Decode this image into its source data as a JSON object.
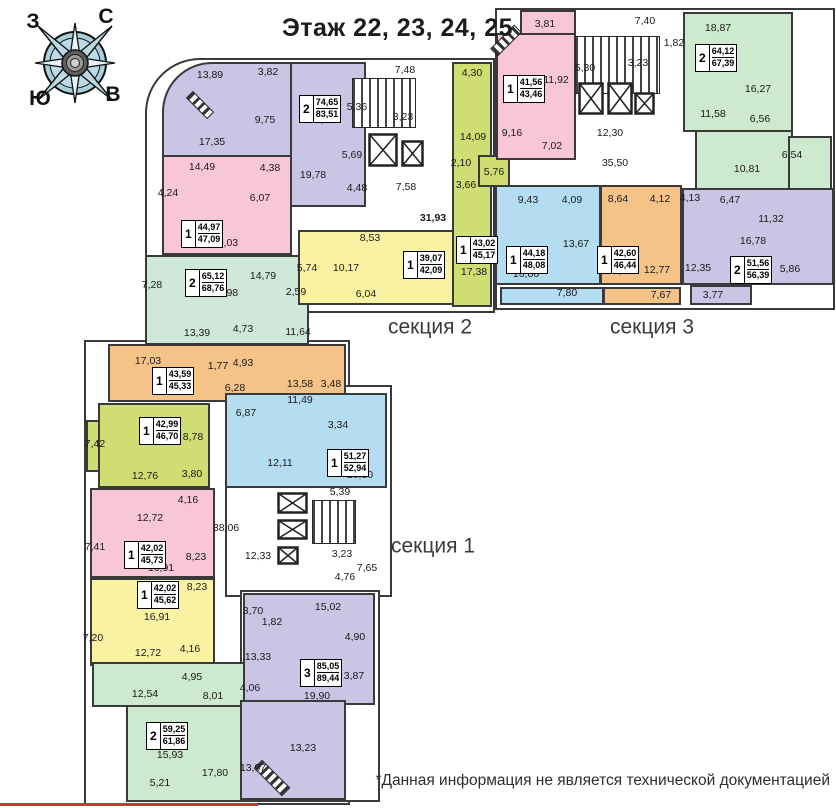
{
  "title": "Этаж 22, 23, 24, 25",
  "disclaimer": "*Данная информация не является технической документацией",
  "compass": {
    "north": "С",
    "south": "Ю",
    "west": "З",
    "east": "В"
  },
  "sections": [
    {
      "label": "секция 1",
      "x": 433,
      "y": 546
    },
    {
      "label": "секция 2",
      "x": 430,
      "y": 327
    },
    {
      "label": "секция 3",
      "x": 652,
      "y": 327
    }
  ],
  "apartments": [
    {
      "id": "s2-2k-8351",
      "rooms_count": "2",
      "area_living": "74,65",
      "area_total": "83,51",
      "color": "#c9c5e4",
      "badge": [
        299,
        95
      ],
      "blocks": [
        [
          162,
          62,
          130,
          95,
          "50px 0 0 0"
        ],
        [
          290,
          62,
          76,
          145
        ]
      ],
      "rooms": [
        [
          "13,89",
          210,
          75
        ],
        [
          "3,82",
          268,
          72
        ],
        [
          "9,75",
          265,
          120
        ],
        [
          "17,35",
          212,
          142
        ],
        [
          "17,60",
          322,
          120
        ],
        [
          "5,36",
          357,
          107
        ],
        [
          "5,69",
          352,
          155
        ],
        [
          "19,78",
          313,
          175
        ],
        [
          "4,48",
          357,
          188
        ]
      ]
    },
    {
      "id": "s2-1k-4709",
      "rooms_count": "1",
      "area_living": "44,97",
      "area_total": "47,09",
      "color": "#f7c6d8",
      "badge": [
        181,
        220
      ],
      "blocks": [
        [
          162,
          155,
          130,
          100
        ]
      ],
      "rooms": [
        [
          "14,49",
          202,
          167
        ],
        [
          "4,38",
          270,
          168
        ],
        [
          "4,24",
          168,
          193
        ],
        [
          "6,07",
          260,
          198
        ],
        [
          "20,03",
          225,
          243
        ]
      ]
    },
    {
      "id": "s2-2k-6876",
      "rooms_count": "2",
      "area_living": "65,12",
      "area_total": "68,76",
      "color": "#cfe8da",
      "badge": [
        185,
        269
      ],
      "blocks": [
        [
          145,
          255,
          164,
          90
        ]
      ],
      "rooms": [
        [
          "14,79",
          263,
          276
        ],
        [
          "7,28",
          152,
          285
        ],
        [
          "17,98",
          225,
          293
        ],
        [
          "2,59",
          296,
          292
        ],
        [
          "13,39",
          197,
          333
        ],
        [
          "4,73",
          243,
          329
        ],
        [
          "11,64",
          298,
          332
        ]
      ]
    },
    {
      "id": "s2-1k-4209",
      "rooms_count": "1",
      "area_living": "39,07",
      "area_total": "42,09",
      "color": "#faf2a3",
      "badge": [
        403,
        251
      ],
      "blocks": [
        [
          298,
          230,
          192,
          75
        ]
      ],
      "rooms": [
        [
          "8,53",
          370,
          238
        ],
        [
          "5,74",
          307,
          268
        ],
        [
          "10,17",
          346,
          268
        ],
        [
          "14,63",
          431,
          275
        ],
        [
          "6,04",
          366,
          294
        ]
      ]
    },
    {
      "id": "s2-1k-4517",
      "rooms_count": "1",
      "area_living": "43,02",
      "area_total": "45,17",
      "color": "#cfdd73",
      "badge": [
        456,
        236
      ],
      "blocks": [
        [
          452,
          62,
          40,
          245
        ],
        [
          478,
          155,
          32,
          32
        ]
      ],
      "rooms": [
        [
          "4,30",
          472,
          73
        ],
        [
          "14,09",
          473,
          137
        ],
        [
          "2,10",
          461,
          163
        ],
        [
          "3,66",
          466,
          185
        ],
        [
          "5,76",
          494,
          172
        ],
        [
          "17,38",
          474,
          272
        ]
      ]
    },
    {
      "id": "s3-1k-4346",
      "rooms_count": "1",
      "area_living": "41,56",
      "area_total": "43,46",
      "color": "#f7c6d8",
      "badge": [
        503,
        75
      ],
      "blocks": [
        [
          520,
          10,
          56,
          30
        ],
        [
          496,
          33,
          80,
          127
        ]
      ],
      "rooms": [
        [
          "3,81",
          545,
          24
        ],
        [
          "11,92",
          556,
          80
        ],
        [
          "14,36",
          522,
          99
        ],
        [
          "9,16",
          512,
          133
        ],
        [
          "7,02",
          552,
          146
        ]
      ]
    },
    {
      "id": "s3-2k-6739",
      "rooms_count": "2",
      "area_living": "64,12",
      "area_total": "67,39",
      "color": "#cde9ce",
      "badge": [
        695,
        44
      ],
      "blocks": [
        [
          683,
          12,
          110,
          120
        ],
        [
          695,
          130,
          98,
          62
        ],
        [
          788,
          136,
          44,
          54
        ]
      ],
      "rooms": [
        [
          "18,87",
          718,
          28
        ],
        [
          "16,27",
          758,
          89
        ],
        [
          "11,58",
          713,
          114
        ],
        [
          "6,56",
          760,
          119
        ],
        [
          "6,54",
          792,
          155
        ],
        [
          "10,81",
          747,
          169
        ]
      ]
    },
    {
      "id": "s3-1k-4808",
      "rooms_count": "1",
      "area_living": "44,18",
      "area_total": "48,08",
      "color": "#b5ddf2",
      "badge": [
        506,
        246
      ],
      "blocks": [
        [
          495,
          185,
          106,
          100
        ],
        [
          500,
          287,
          104,
          18
        ]
      ],
      "rooms": [
        [
          "9,43",
          528,
          200
        ],
        [
          "4,09",
          572,
          200
        ],
        [
          "13,67",
          576,
          244
        ],
        [
          "16,86",
          526,
          274
        ],
        [
          "7,80",
          567,
          293
        ]
      ]
    },
    {
      "id": "s3-1k-4644",
      "rooms_count": "1",
      "area_living": "42,60",
      "area_total": "46,44",
      "color": "#f5c388",
      "badge": [
        597,
        246
      ],
      "blocks": [
        [
          600,
          185,
          82,
          100
        ],
        [
          603,
          287,
          78,
          18
        ]
      ],
      "rooms": [
        [
          "8,64",
          618,
          199
        ],
        [
          "4,12",
          660,
          199
        ],
        [
          "16,91",
          620,
          271
        ],
        [
          "12,77",
          657,
          270
        ],
        [
          "7,67",
          661,
          295
        ]
      ]
    },
    {
      "id": "s3-2k-5639",
      "rooms_count": "2",
      "area_living": "51,56",
      "area_total": "56,39",
      "color": "#c9c5e4",
      "badge": [
        730,
        256
      ],
      "blocks": [
        [
          682,
          188,
          152,
          97
        ],
        [
          690,
          285,
          62,
          20
        ]
      ],
      "rooms": [
        [
          "4,13",
          690,
          198
        ],
        [
          "6,47",
          730,
          200
        ],
        [
          "11,32",
          771,
          219
        ],
        [
          "16,78",
          753,
          241
        ],
        [
          "12,35",
          698,
          268
        ],
        [
          "5,86",
          790,
          269
        ],
        [
          "3,77",
          713,
          295
        ]
      ]
    },
    {
      "id": "s1-1k-4533",
      "rooms_count": "1",
      "area_living": "43,59",
      "area_total": "45,33",
      "color": "#f5c388",
      "badge": [
        152,
        367
      ],
      "blocks": [
        [
          108,
          344,
          238,
          58
        ]
      ],
      "rooms": [
        [
          "17,03",
          148,
          361
        ],
        [
          "1,77",
          218,
          366
        ],
        [
          "4,93",
          243,
          363
        ],
        [
          "6,28",
          235,
          388
        ],
        [
          "13,58",
          300,
          384
        ],
        [
          "3,48",
          331,
          384
        ]
      ]
    },
    {
      "id": "s1-1k-4670",
      "rooms_count": "1",
      "area_living": "42,99",
      "area_total": "46,70",
      "color": "#cfdd73",
      "badge": [
        139,
        417
      ],
      "blocks": [
        [
          98,
          403,
          112,
          85
        ],
        [
          86,
          420,
          14,
          52
        ]
      ],
      "rooms": [
        [
          "7,42",
          95,
          444
        ],
        [
          "17,65",
          155,
          440
        ],
        [
          "8,78",
          193,
          437
        ],
        [
          "12,76",
          145,
          476
        ],
        [
          "3,80",
          192,
          474
        ]
      ]
    },
    {
      "id": "s1-1k-5294",
      "rooms_count": "1",
      "area_living": "51,27",
      "area_total": "52,94",
      "color": "#b5ddf2",
      "badge": [
        327,
        449
      ],
      "blocks": [
        [
          225,
          393,
          162,
          95
        ]
      ],
      "rooms": [
        [
          "6,87",
          246,
          413
        ],
        [
          "11,49",
          300,
          400
        ],
        [
          "3,34",
          338,
          425
        ],
        [
          "12,11",
          280,
          463
        ],
        [
          "20,80",
          360,
          475
        ]
      ]
    },
    {
      "id": "s1-1k-4573",
      "rooms_count": "1",
      "area_living": "42,02",
      "area_total": "45,73",
      "color": "#f7c6d8",
      "badge": [
        124,
        541
      ],
      "blocks": [
        [
          90,
          488,
          125,
          90
        ]
      ],
      "rooms": [
        [
          "4,16",
          188,
          500
        ],
        [
          "12,72",
          150,
          518
        ],
        [
          "7,41",
          95,
          547
        ],
        [
          "8,23",
          196,
          557
        ],
        [
          "16,91",
          161,
          568
        ]
      ]
    },
    {
      "id": "s1-1k-4562",
      "rooms_count": "1",
      "area_living": "42,02",
      "area_total": "45,62",
      "color": "#faf2a3",
      "badge": [
        137,
        581
      ],
      "blocks": [
        [
          90,
          578,
          125,
          88
        ]
      ],
      "rooms": [
        [
          "8,23",
          197,
          587
        ],
        [
          "16,91",
          157,
          617
        ],
        [
          "7,20",
          93,
          638
        ],
        [
          "12,72",
          148,
          653
        ],
        [
          "4,16",
          190,
          649
        ]
      ]
    },
    {
      "id": "s1-2k-6186",
      "rooms_count": "2",
      "area_living": "59,25",
      "area_total": "61,86",
      "color": "#cde9ce",
      "badge": [
        146,
        722
      ],
      "blocks": [
        [
          92,
          662,
          156,
          45
        ],
        [
          126,
          705,
          120,
          97
        ]
      ],
      "rooms": [
        [
          "4,95",
          192,
          677
        ],
        [
          "12,54",
          145,
          694
        ],
        [
          "8,01",
          213,
          696
        ],
        [
          "15,93",
          170,
          755
        ],
        [
          "5,21",
          160,
          783
        ],
        [
          "17,80",
          215,
          773
        ]
      ]
    },
    {
      "id": "s1-3k-8944",
      "rooms_count": "3",
      "area_living": "85,05",
      "area_total": "89,44",
      "color": "#c9c5e4",
      "badge": [
        300,
        659
      ],
      "blocks": [
        [
          243,
          593,
          132,
          112
        ],
        [
          240,
          700,
          106,
          100
        ]
      ],
      "rooms": [
        [
          "3,70",
          253,
          611
        ],
        [
          "1,82",
          272,
          622
        ],
        [
          "15,02",
          328,
          607
        ],
        [
          "4,90",
          355,
          637
        ],
        [
          "13,33",
          258,
          657
        ],
        [
          "4,06",
          250,
          688
        ],
        [
          "3,87",
          354,
          676
        ],
        [
          "19,90",
          317,
          696
        ],
        [
          "13,97",
          253,
          768
        ],
        [
          "13,23",
          303,
          748
        ]
      ]
    }
  ],
  "core_labels": [
    [
      "7,48",
      405,
      70
    ],
    [
      "3,23",
      403,
      117
    ],
    [
      "7,58",
      406,
      187
    ],
    [
      "31,93",
      433,
      218,
      true
    ],
    [
      "7,40",
      645,
      21
    ],
    [
      "1,82",
      674,
      43
    ],
    [
      "5,30",
      585,
      68
    ],
    [
      "3,23",
      638,
      63
    ],
    [
      "12,30",
      610,
      133
    ],
    [
      "35,50",
      615,
      163
    ],
    [
      "5,39",
      340,
      492
    ],
    [
      "38,06",
      226,
      528
    ],
    [
      "12,33",
      258,
      556
    ],
    [
      "3,23",
      342,
      554
    ],
    [
      "7,65",
      367,
      568
    ],
    [
      "4,76",
      345,
      577
    ]
  ]
}
